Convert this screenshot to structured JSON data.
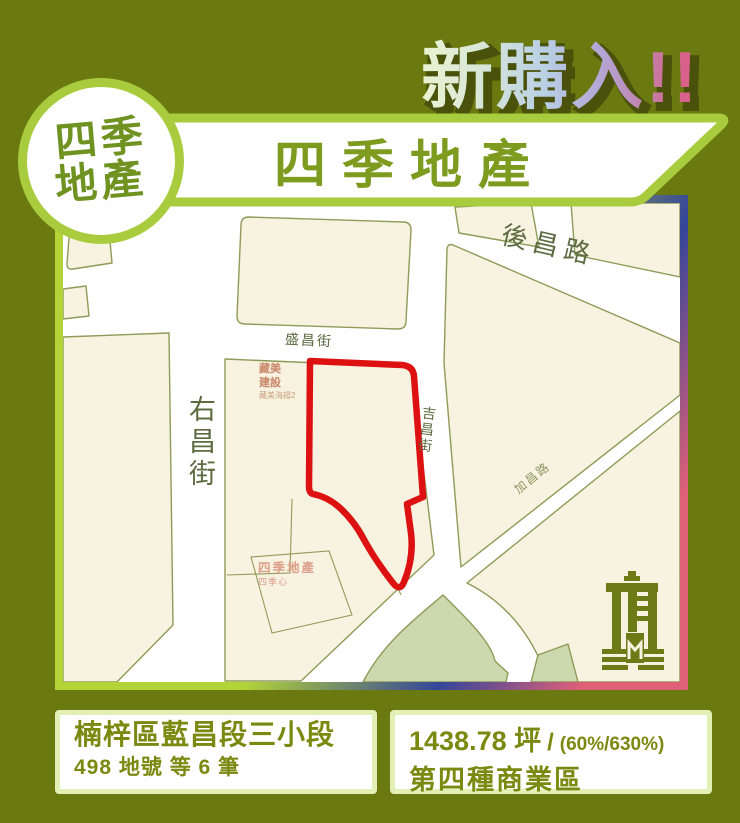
{
  "headline": {
    "text": "新購入!!",
    "shadow_color": "#49510b",
    "gradient": [
      "#eaf3d0",
      "#b9d0e5",
      "#b2a7d7",
      "#d9618c"
    ]
  },
  "logo": {
    "line1": "四季",
    "line2": "地產",
    "text_color": "#6f9221",
    "ring_color": "#a9cc3e"
  },
  "banner": {
    "title": "四季地產",
    "text_color": "#7d9b1e",
    "border_color": "#a9cc3e"
  },
  "map": {
    "roads": {
      "houchang": "後昌路",
      "shengchang": "盛昌街",
      "youchang": "右昌街",
      "jichang": "吉昌街",
      "jiachang": "加昌路"
    },
    "pois": {
      "builder_line1": "藏美",
      "builder_line2": "建設",
      "builder_sub": "藏美海揚2",
      "agency": "四季地產",
      "agency_sub": "四季心"
    },
    "colors": {
      "block": "#f8f2e0",
      "road": "#ffffff",
      "outline": "#8f9b58",
      "park": "#ccd8ae",
      "site_outline": "#dd1111",
      "frame_green": "#b3d437",
      "frame_blue": "#35459a",
      "frame_pink": "#e06078"
    }
  },
  "info_left": {
    "title": "楠梓區藍昌段三小段",
    "subtitle": "498 地號 等 6 筆"
  },
  "info_right": {
    "area": "1438.78 坪",
    "separator": "/",
    "ratio": "(60%/630%)",
    "zoning": "第四種商業區"
  }
}
